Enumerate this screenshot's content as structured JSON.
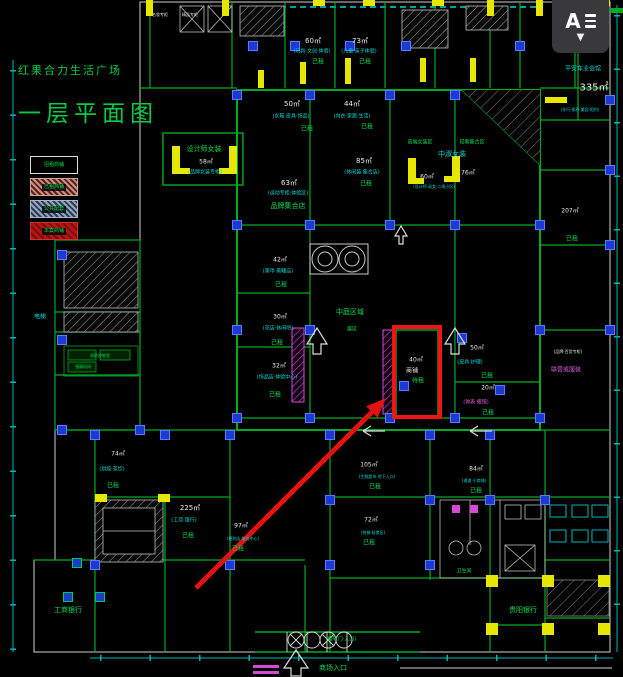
{
  "palette": {
    "background": "#000000",
    "wall_green": "#00aa22",
    "wall_light": "#cfcfcf",
    "dimension_cyan": "#00b3b3",
    "column_blue": "#1d39d4",
    "door_yellow": "#e6e600",
    "escalator_magenta": "#d44ad4",
    "status_green": "#00e050",
    "area_text_white": "#e9e9e9",
    "highlight_red": "#f01515",
    "title_green": "#00cc44",
    "widget_bg": "#39393d"
  },
  "title_block": {
    "project_name": "红果合力生活广场",
    "drawing_name": "一层平面图"
  },
  "legend": {
    "items": [
      {
        "label": "招租商铺",
        "swatch": "outline-black"
      },
      {
        "label": "已租商铺",
        "swatch": "pink-hatch"
      },
      {
        "label": "公共配套",
        "swatch": "blue-hatch"
      },
      {
        "label": "本案商铺",
        "swatch": "red-solid"
      }
    ]
  },
  "widget": {
    "tool_letter": "A",
    "icon": "text-align-lines",
    "dropdown_glyph": "▼"
  },
  "annotation": {
    "highlight_room_area": "40㎡",
    "highlight_room_line2": "商铺",
    "highlight_room_status": "待租",
    "shape": "red rectangle with red arrow pointing from lower-left"
  },
  "plan": {
    "entrance_label": "商场入口",
    "labels": [
      {
        "t": "名妆专柜",
        "x": 160,
        "y": 15,
        "c": "white",
        "s": 4
      },
      {
        "t": "精品专柜",
        "x": 190,
        "y": 15,
        "c": "white",
        "s": 4
      },
      {
        "t": "60㎡",
        "x": 313,
        "y": 42,
        "c": "white",
        "s": 7
      },
      {
        "t": "(玩具·文创·体验)",
        "x": 312,
        "y": 52,
        "c": "cyan",
        "s": 5
      },
      {
        "t": "已租",
        "x": 318,
        "y": 63,
        "c": "green",
        "s": 6
      },
      {
        "t": "73㎡",
        "x": 360,
        "y": 42,
        "c": "white",
        "s": 7
      },
      {
        "t": "(儿童·亲子体验)",
        "x": 359,
        "y": 52,
        "c": "cyan",
        "s": 5
      },
      {
        "t": "已租",
        "x": 365,
        "y": 63,
        "c": "green",
        "s": 6
      },
      {
        "t": "平安车业会馆",
        "x": 583,
        "y": 70,
        "c": "cyan",
        "s": 6
      },
      {
        "t": "335㎡",
        "x": 594,
        "y": 88,
        "c": "white",
        "s": 10
      },
      {
        "t": "(车行·保养·美容·租约)",
        "x": 580,
        "y": 110,
        "c": "cyan",
        "s": 4
      },
      {
        "t": "设计师女装",
        "x": 204,
        "y": 150,
        "c": "green",
        "s": 7
      },
      {
        "t": "58㎡",
        "x": 206,
        "y": 163,
        "c": "white",
        "s": 6
      },
      {
        "t": "(品牌女装专柜)",
        "x": 205,
        "y": 173,
        "c": "cyan",
        "s": 5
      },
      {
        "t": "50㎡",
        "x": 292,
        "y": 105,
        "c": "white",
        "s": 7
      },
      {
        "t": "(女鞋·皮具·饰品)",
        "x": 291,
        "y": 117,
        "c": "cyan",
        "s": 5
      },
      {
        "t": "已租",
        "x": 307,
        "y": 130,
        "c": "green",
        "s": 6
      },
      {
        "t": "44㎡",
        "x": 352,
        "y": 105,
        "c": "white",
        "s": 7
      },
      {
        "t": "(内衣·家居·生活)",
        "x": 352,
        "y": 117,
        "c": "cyan",
        "s": 5
      },
      {
        "t": "已租",
        "x": 367,
        "y": 128,
        "c": "green",
        "s": 6
      },
      {
        "t": "63㎡",
        "x": 289,
        "y": 184,
        "c": "white",
        "s": 7
      },
      {
        "t": "(运动专柜·体验区)",
        "x": 288,
        "y": 194,
        "c": "cyan",
        "s": 5
      },
      {
        "t": "品牌集合店",
        "x": 288,
        "y": 207,
        "c": "green",
        "s": 7
      },
      {
        "t": "85㎡",
        "x": 364,
        "y": 162,
        "c": "white",
        "s": 7
      },
      {
        "t": "(休闲装·集合店)",
        "x": 362,
        "y": 173,
        "c": "cyan",
        "s": 5
      },
      {
        "t": "已租",
        "x": 366,
        "y": 185,
        "c": "green",
        "s": 6
      },
      {
        "t": "高端女装区",
        "x": 420,
        "y": 143,
        "c": "green",
        "s": 5
      },
      {
        "t": "轻奢集合区",
        "x": 472,
        "y": 143,
        "c": "green",
        "s": 5
      },
      {
        "t": "中淑女装",
        "x": 452,
        "y": 155,
        "c": "cyan",
        "s": 7
      },
      {
        "t": "60㎡",
        "x": 427,
        "y": 178,
        "c": "white",
        "s": 6
      },
      {
        "t": "76㎡",
        "x": 468,
        "y": 174,
        "c": "white",
        "s": 6
      },
      {
        "t": "(设计师·淑女·二线小区)",
        "x": 434,
        "y": 187,
        "c": "cyan",
        "s": 4
      },
      {
        "t": "电梯",
        "x": 40,
        "y": 318,
        "c": "cyan",
        "s": 6
      },
      {
        "t": "消防控制室",
        "x": 100,
        "y": 356,
        "c": "green",
        "s": 4
      },
      {
        "t": "强弱电间",
        "x": 83,
        "y": 367,
        "c": "green",
        "s": 4
      },
      {
        "t": "42㎡",
        "x": 280,
        "y": 261,
        "c": "white",
        "s": 6
      },
      {
        "t": "(美甲·美睫店)",
        "x": 278,
        "y": 272,
        "c": "cyan",
        "s": 5
      },
      {
        "t": "已租",
        "x": 281,
        "y": 286,
        "c": "green",
        "s": 6
      },
      {
        "t": "30㎡",
        "x": 280,
        "y": 318,
        "c": "white",
        "s": 6
      },
      {
        "t": "(花店·休闲吧)",
        "x": 278,
        "y": 329,
        "c": "cyan",
        "s": 5
      },
      {
        "t": "已租",
        "x": 277,
        "y": 344,
        "c": "green",
        "s": 6
      },
      {
        "t": "32㎡",
        "x": 279,
        "y": 367,
        "c": "white",
        "s": 6
      },
      {
        "t": "(饰品店·体验中心)",
        "x": 277,
        "y": 378,
        "c": "cyan",
        "s": 5
      },
      {
        "t": "已租",
        "x": 275,
        "y": 396,
        "c": "green",
        "s": 6
      },
      {
        "t": "中庭区域",
        "x": 350,
        "y": 313,
        "c": "green",
        "s": 7
      },
      {
        "t": "展区",
        "x": 352,
        "y": 330,
        "c": "green",
        "s": 5
      },
      {
        "t": "40㎡",
        "x": 416,
        "y": 361,
        "c": "white",
        "s": 6
      },
      {
        "t": "商铺",
        "x": 412,
        "y": 372,
        "c": "white",
        "s": 6
      },
      {
        "t": "待租",
        "x": 418,
        "y": 382,
        "c": "green",
        "s": 6
      },
      {
        "t": "50㎡",
        "x": 477,
        "y": 349,
        "c": "white",
        "s": 6
      },
      {
        "t": "(皮具·护理)",
        "x": 470,
        "y": 363,
        "c": "cyan",
        "s": 5
      },
      {
        "t": "已租",
        "x": 487,
        "y": 377,
        "c": "green",
        "s": 6
      },
      {
        "t": "20㎡",
        "x": 488,
        "y": 389,
        "c": "white",
        "s": 6
      },
      {
        "t": "(钟表·眼镜)",
        "x": 476,
        "y": 403,
        "c": "magenta",
        "s": 5
      },
      {
        "t": "已租",
        "x": 488,
        "y": 414,
        "c": "green",
        "s": 6
      },
      {
        "t": "207㎡",
        "x": 570,
        "y": 212,
        "c": "white",
        "s": 6
      },
      {
        "t": "已租",
        "x": 572,
        "y": 240,
        "c": "green",
        "s": 6
      },
      {
        "t": "(品牌·百货专柜)",
        "x": 568,
        "y": 352,
        "c": "white",
        "s": 4
      },
      {
        "t": "联营或服装",
        "x": 566,
        "y": 371,
        "c": "magenta",
        "s": 6
      },
      {
        "t": "74㎡",
        "x": 118,
        "y": 455,
        "c": "white",
        "s": 6
      },
      {
        "t": "(烘焙·茶饮)",
        "x": 112,
        "y": 470,
        "c": "cyan",
        "s": 5
      },
      {
        "t": "已租",
        "x": 113,
        "y": 487,
        "c": "green",
        "s": 6
      },
      {
        "t": "225㎡",
        "x": 190,
        "y": 509,
        "c": "white",
        "s": 7
      },
      {
        "t": "(工商·银行)",
        "x": 184,
        "y": 521,
        "c": "cyan",
        "s": 5
      },
      {
        "t": "已租",
        "x": 188,
        "y": 537,
        "c": "green",
        "s": 6
      },
      {
        "t": "97㎡",
        "x": 241,
        "y": 527,
        "c": "white",
        "s": 6
      },
      {
        "t": "(便利店·服务中心)",
        "x": 243,
        "y": 539,
        "c": "cyan",
        "s": 4
      },
      {
        "t": "已租",
        "x": 238,
        "y": 550,
        "c": "green",
        "s": 6
      },
      {
        "t": "105㎡",
        "x": 369,
        "y": 466,
        "c": "white",
        "s": 6
      },
      {
        "t": "(生鲜超市·地下入口)",
        "x": 377,
        "y": 477,
        "c": "cyan",
        "s": 4
      },
      {
        "t": "已租",
        "x": 375,
        "y": 488,
        "c": "green",
        "s": 6
      },
      {
        "t": "72㎡",
        "x": 371,
        "y": 521,
        "c": "white",
        "s": 6
      },
      {
        "t": "(快餐·轻食区)",
        "x": 373,
        "y": 533,
        "c": "cyan",
        "s": 4
      },
      {
        "t": "已租",
        "x": 369,
        "y": 544,
        "c": "green",
        "s": 6
      },
      {
        "t": "84㎡",
        "x": 476,
        "y": 470,
        "c": "white",
        "s": 6
      },
      {
        "t": "(通道·小商铺)",
        "x": 474,
        "y": 481,
        "c": "cyan",
        "s": 4
      },
      {
        "t": "已租",
        "x": 476,
        "y": 492,
        "c": "green",
        "s": 6
      },
      {
        "t": "卫生间",
        "x": 464,
        "y": 572,
        "c": "green",
        "s": 5
      },
      {
        "t": "工商银行",
        "x": 68,
        "y": 611,
        "c": "green",
        "s": 7
      },
      {
        "t": "贵阳银行",
        "x": 523,
        "y": 611,
        "c": "green",
        "s": 7
      },
      {
        "t": "(旋转门·入口)",
        "x": 341,
        "y": 640,
        "c": "green",
        "s": 5
      },
      {
        "t": "商场入口",
        "x": 333,
        "y": 669,
        "c": "green",
        "s": 7
      }
    ]
  }
}
